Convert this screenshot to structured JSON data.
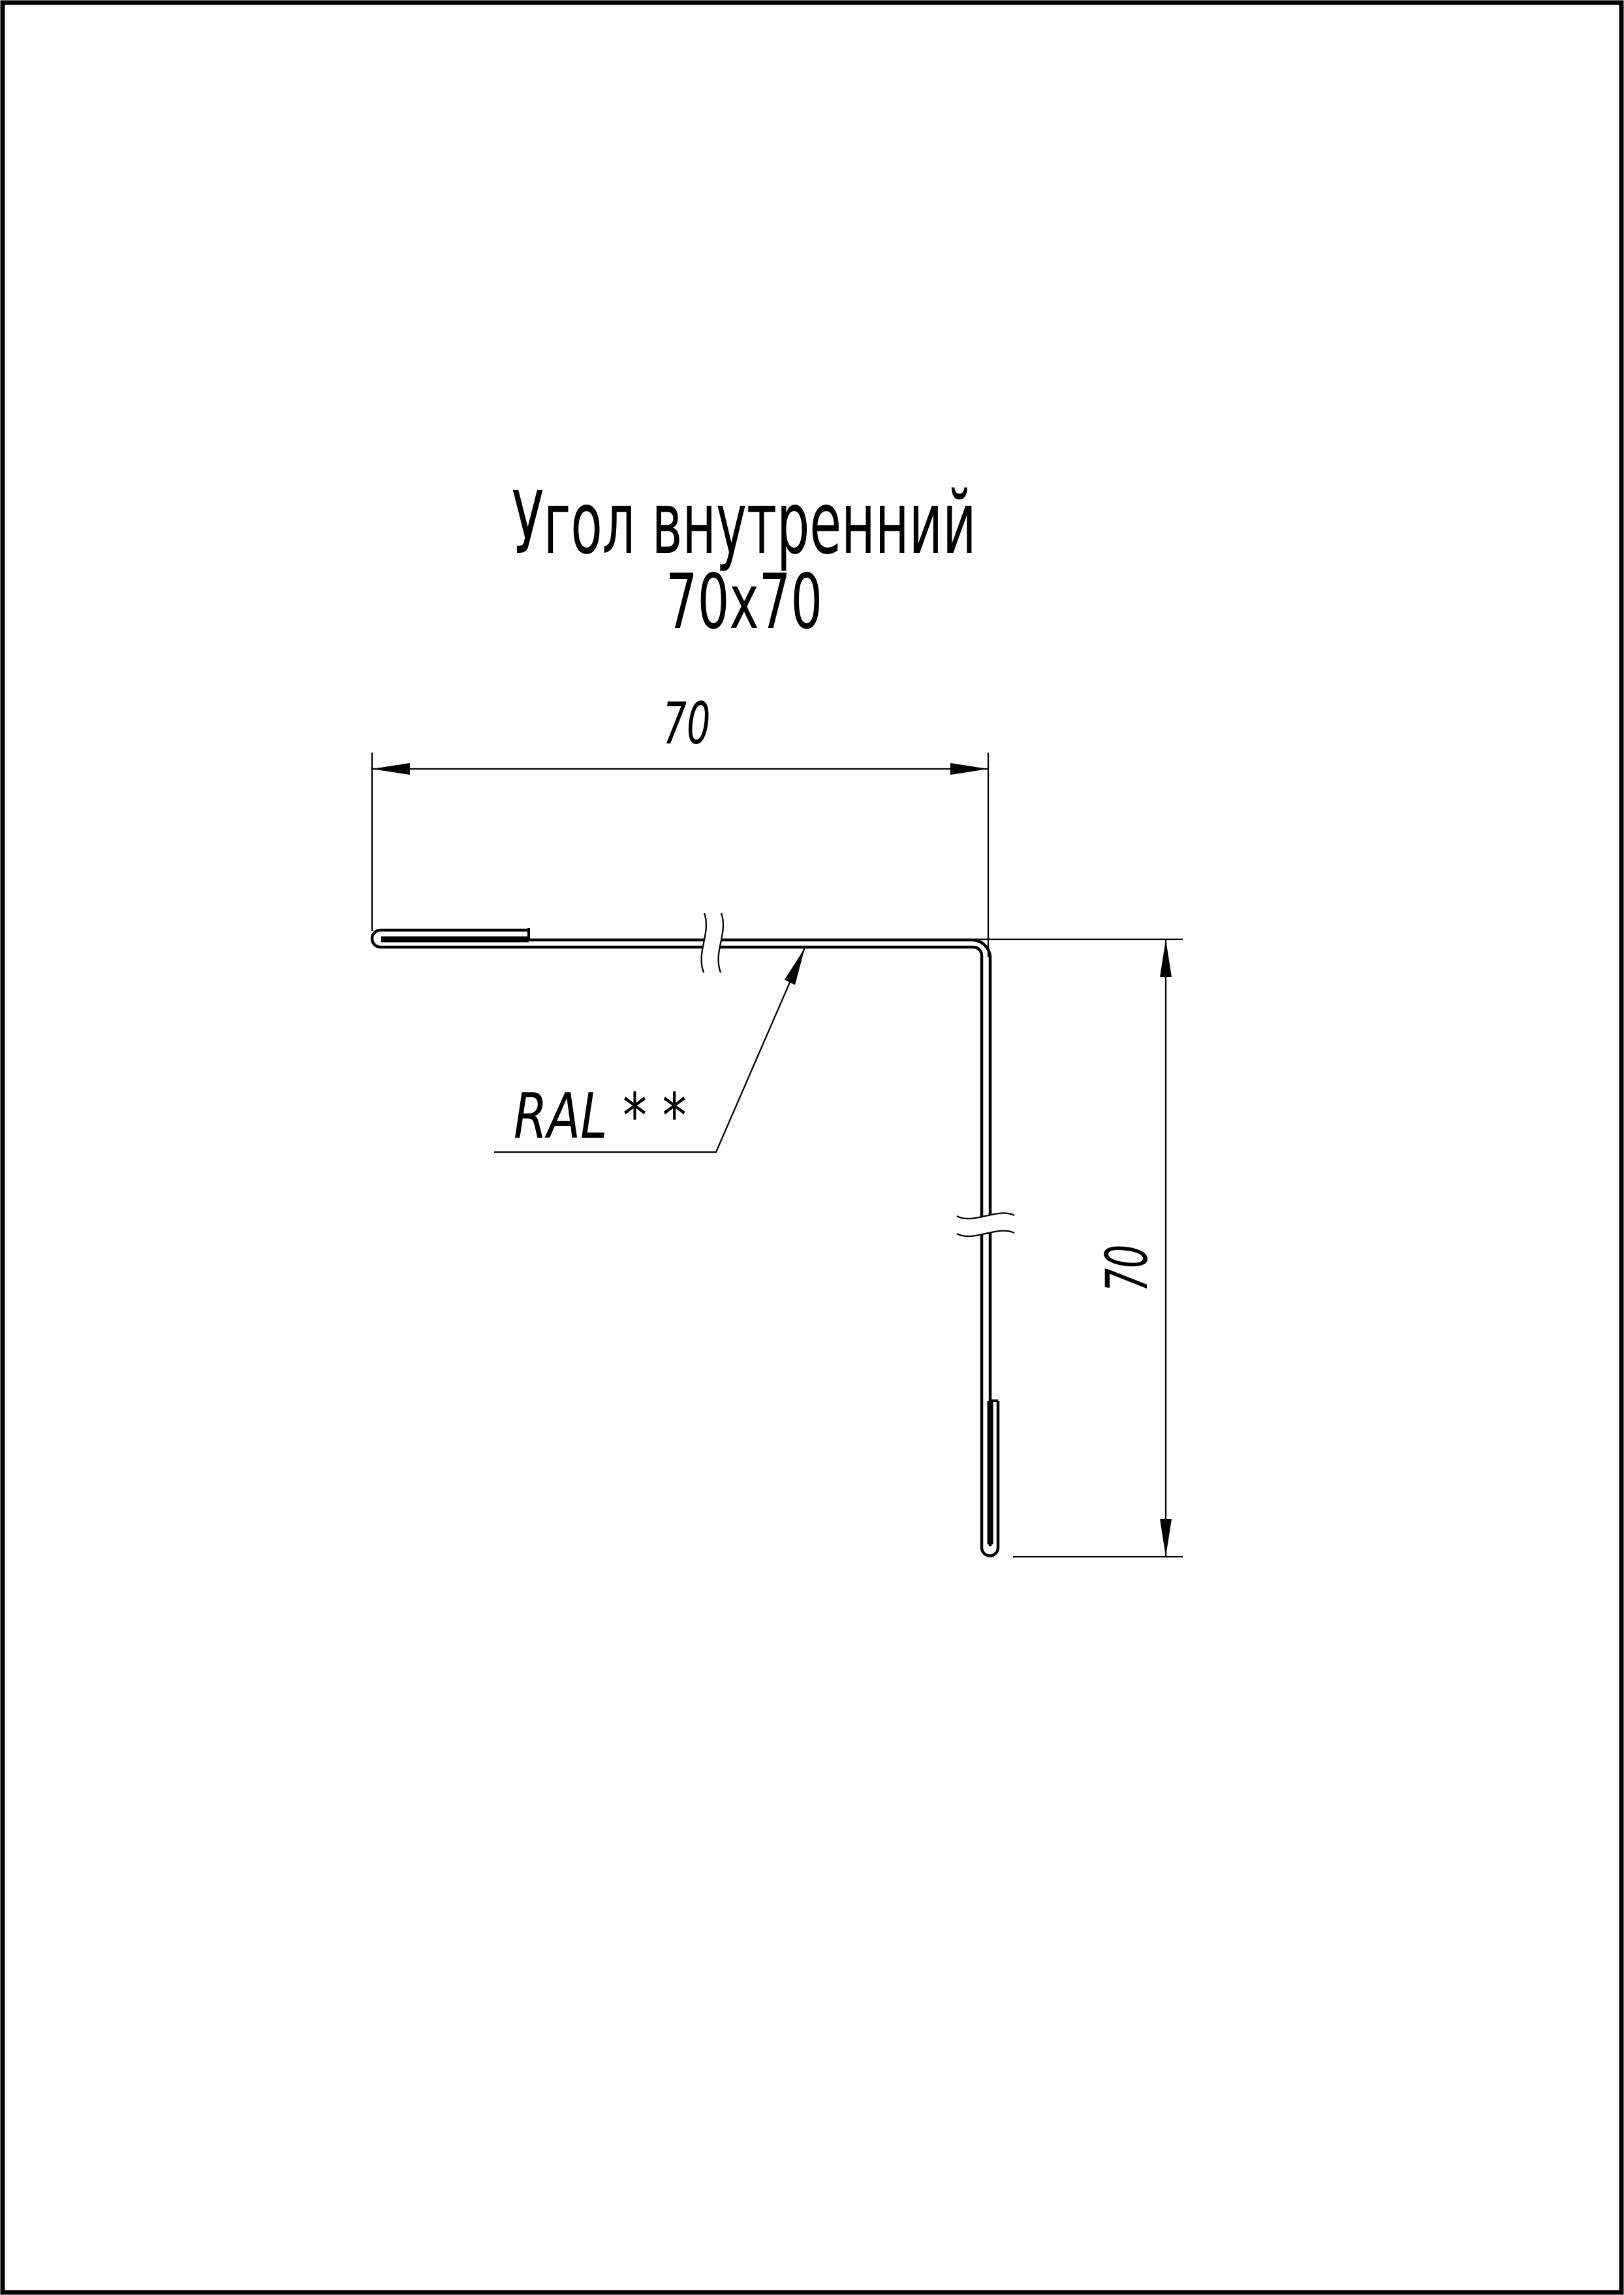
{
  "page": {
    "ink_color": "#000000",
    "paper_color": "#ffffff"
  },
  "title": {
    "line1": "Угол внутренний",
    "line2": "70х70"
  },
  "dimensions": {
    "top": {
      "value": "70"
    },
    "right": {
      "value": "70"
    }
  },
  "labels": {
    "coating": "RAL * *"
  }
}
